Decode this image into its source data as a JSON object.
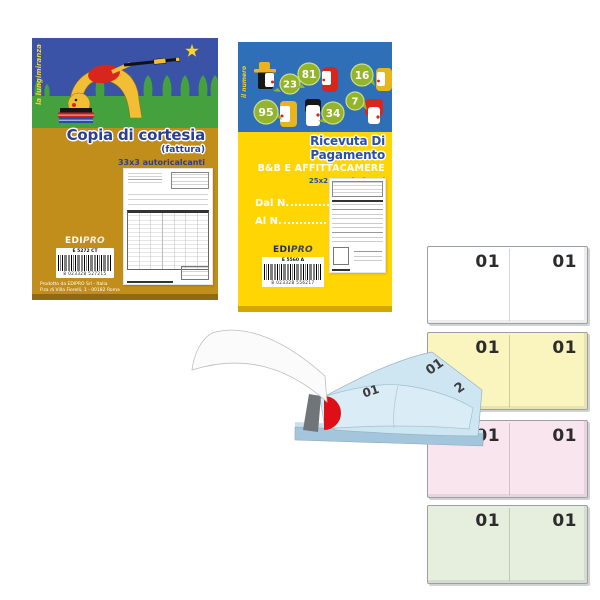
{
  "invoice_book": {
    "vertical_text": "la lungimiranza",
    "title": "Copia di cortesia",
    "subtitle": "(fattura)",
    "format": "33x3 autoricalcanti",
    "brand_edi": "EDI",
    "brand_pro": "PRO",
    "code": "E 5272 CT",
    "barcode_digits": "8 023328 527215",
    "footer_line1": "Prodotto da EDIPRO Srl - Italia",
    "footer_line2": "P.za di Villa Fiorelli, 1 - 00182 Roma",
    "colors": {
      "cover": "#C28E1B",
      "sky": "#3A53A7",
      "grass": "#44A13D",
      "title": "#2B3E92"
    }
  },
  "receipt_book": {
    "vertical_text": "il numero",
    "title": "Ricevuta Di Pagamento",
    "subtitle": "B&B E AFFITTACAMERE",
    "format": "25x2 autoricalcanti",
    "from_label": "Dal N.",
    "to_label": "Al  N.",
    "brand_edi": "EDI",
    "brand_pro": "PRO",
    "code": "E 5560 A",
    "barcode_digits": "8 023328 556217",
    "bubbles": [
      "23",
      "81",
      "16",
      "95",
      "34",
      "7"
    ],
    "colors": {
      "cover": "#FFD504",
      "sky": "#2F6FB7",
      "bubble": "#94B42C",
      "title": "#2B51A5"
    }
  },
  "sample_pad": {
    "sheet1_number": "01",
    "sheet2_number": "01",
    "sheet2_digit": "2"
  },
  "ticket_pads": [
    {
      "name": "white",
      "fill": "#FFFFFF",
      "left": "01",
      "right": "01"
    },
    {
      "name": "yellow",
      "fill": "#FAF5BF",
      "left": "01",
      "right": "01"
    },
    {
      "name": "pink",
      "fill": "#F9E5ED",
      "left": "01",
      "right": "01"
    },
    {
      "name": "green",
      "fill": "#E6EFDE",
      "left": "01",
      "right": "01"
    }
  ]
}
